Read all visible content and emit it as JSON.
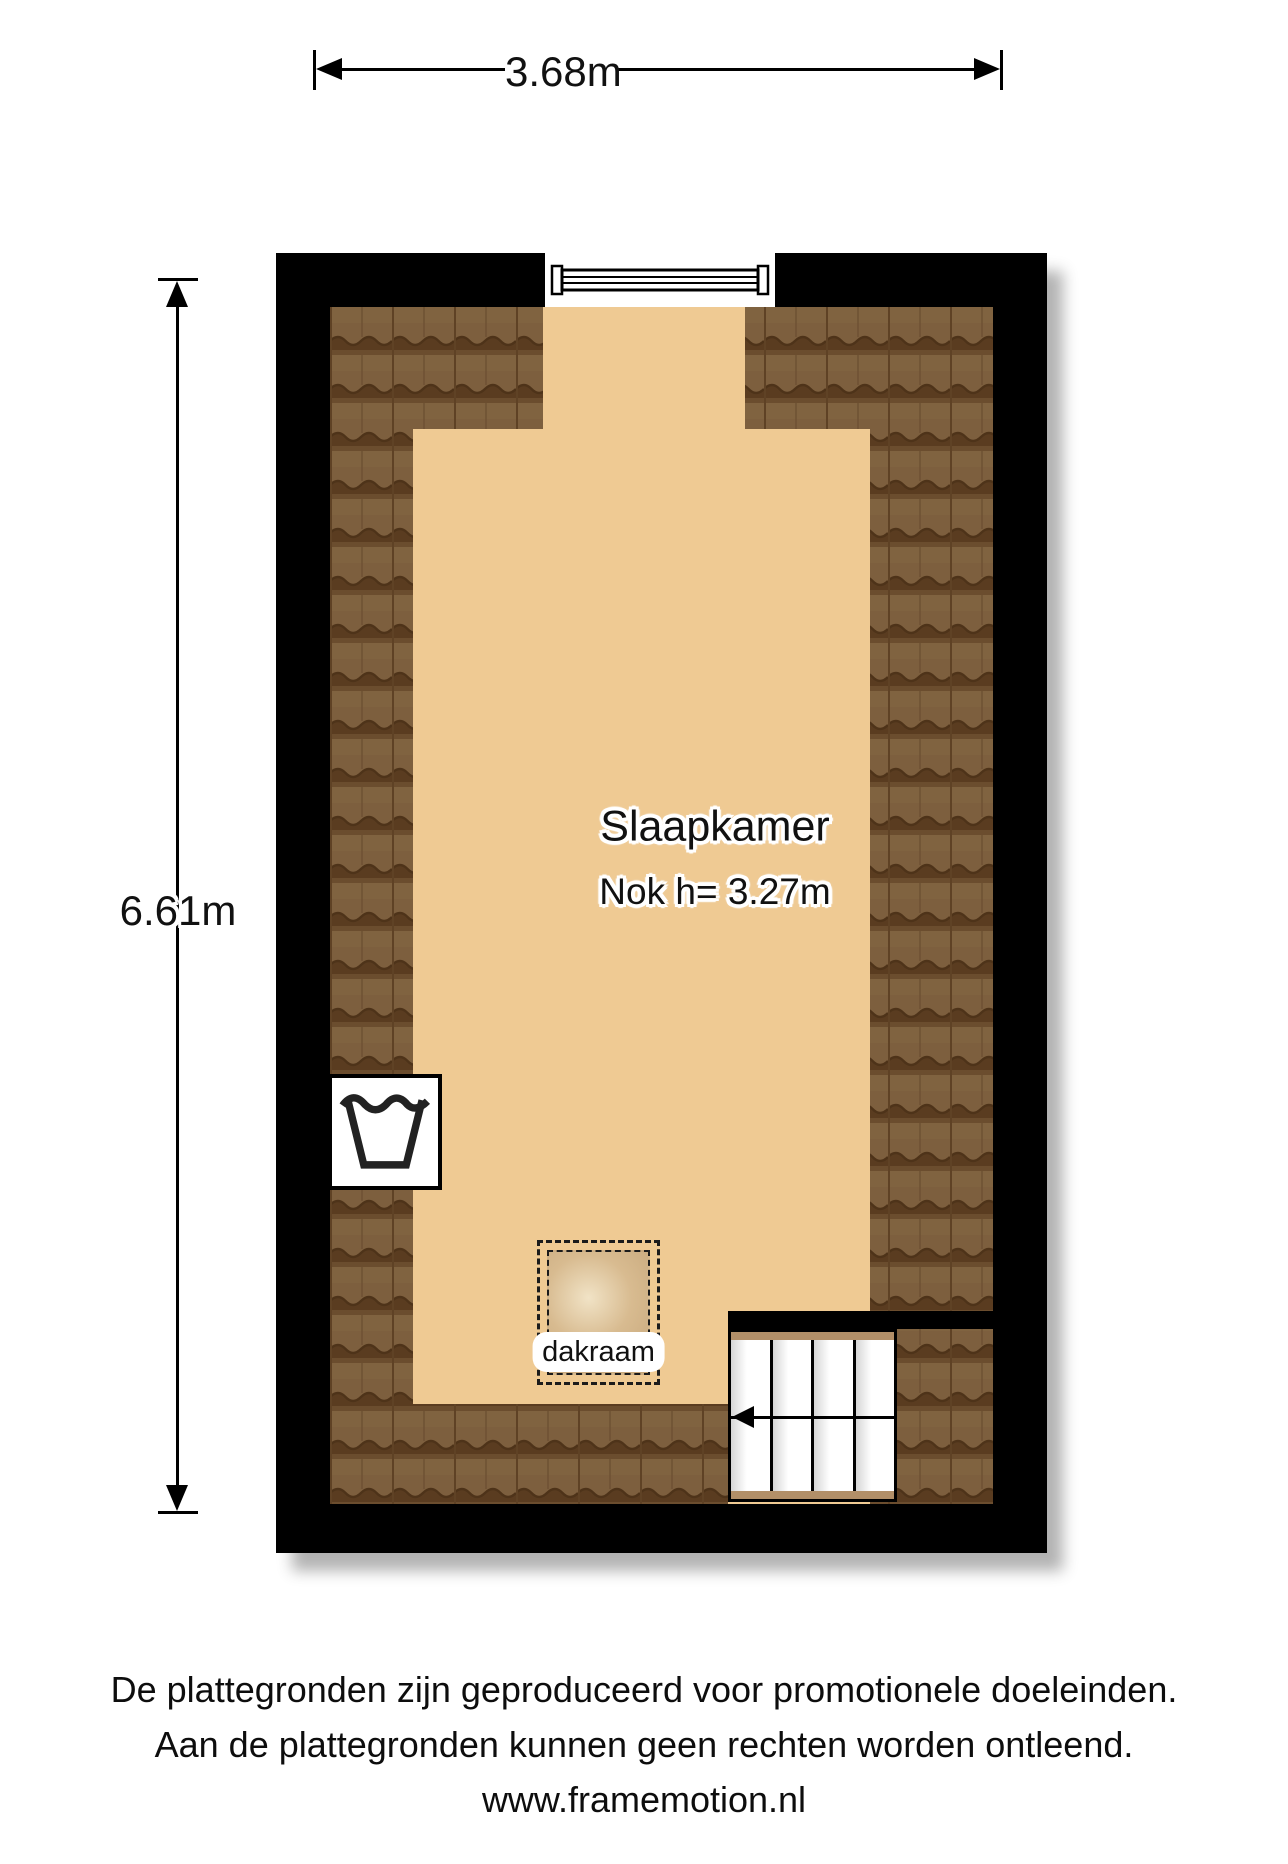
{
  "plan": {
    "room": {
      "name": "Slaapkamer",
      "ridge_height_label": "Nok h= 3.27m"
    },
    "skylight": {
      "label": "dakraam"
    },
    "icons": {
      "wash_symbol": "laundry-handwash-tub-icon",
      "window": "window-plan-symbol",
      "stairs": "staircase-with-direction-arrow",
      "roof": "roof-tile-texture"
    },
    "colors": {
      "wall": "#000000",
      "floor": "#efca93",
      "roof_tile": "#7d5f3e",
      "roof_tile_shadow": "#5a3c20",
      "stair_trim": "#b28f68",
      "skylight_glow": "#f1e3c6"
    }
  },
  "dimensions": {
    "width_label": "3.68m",
    "height_label": "6.61m"
  },
  "footer": {
    "line1": "De plattegronden zijn geproduceerd voor promotionele doeleinden.",
    "line2": "Aan de plattegronden kunnen geen rechten worden ontleend.",
    "line3": "www.framemotion.nl"
  }
}
